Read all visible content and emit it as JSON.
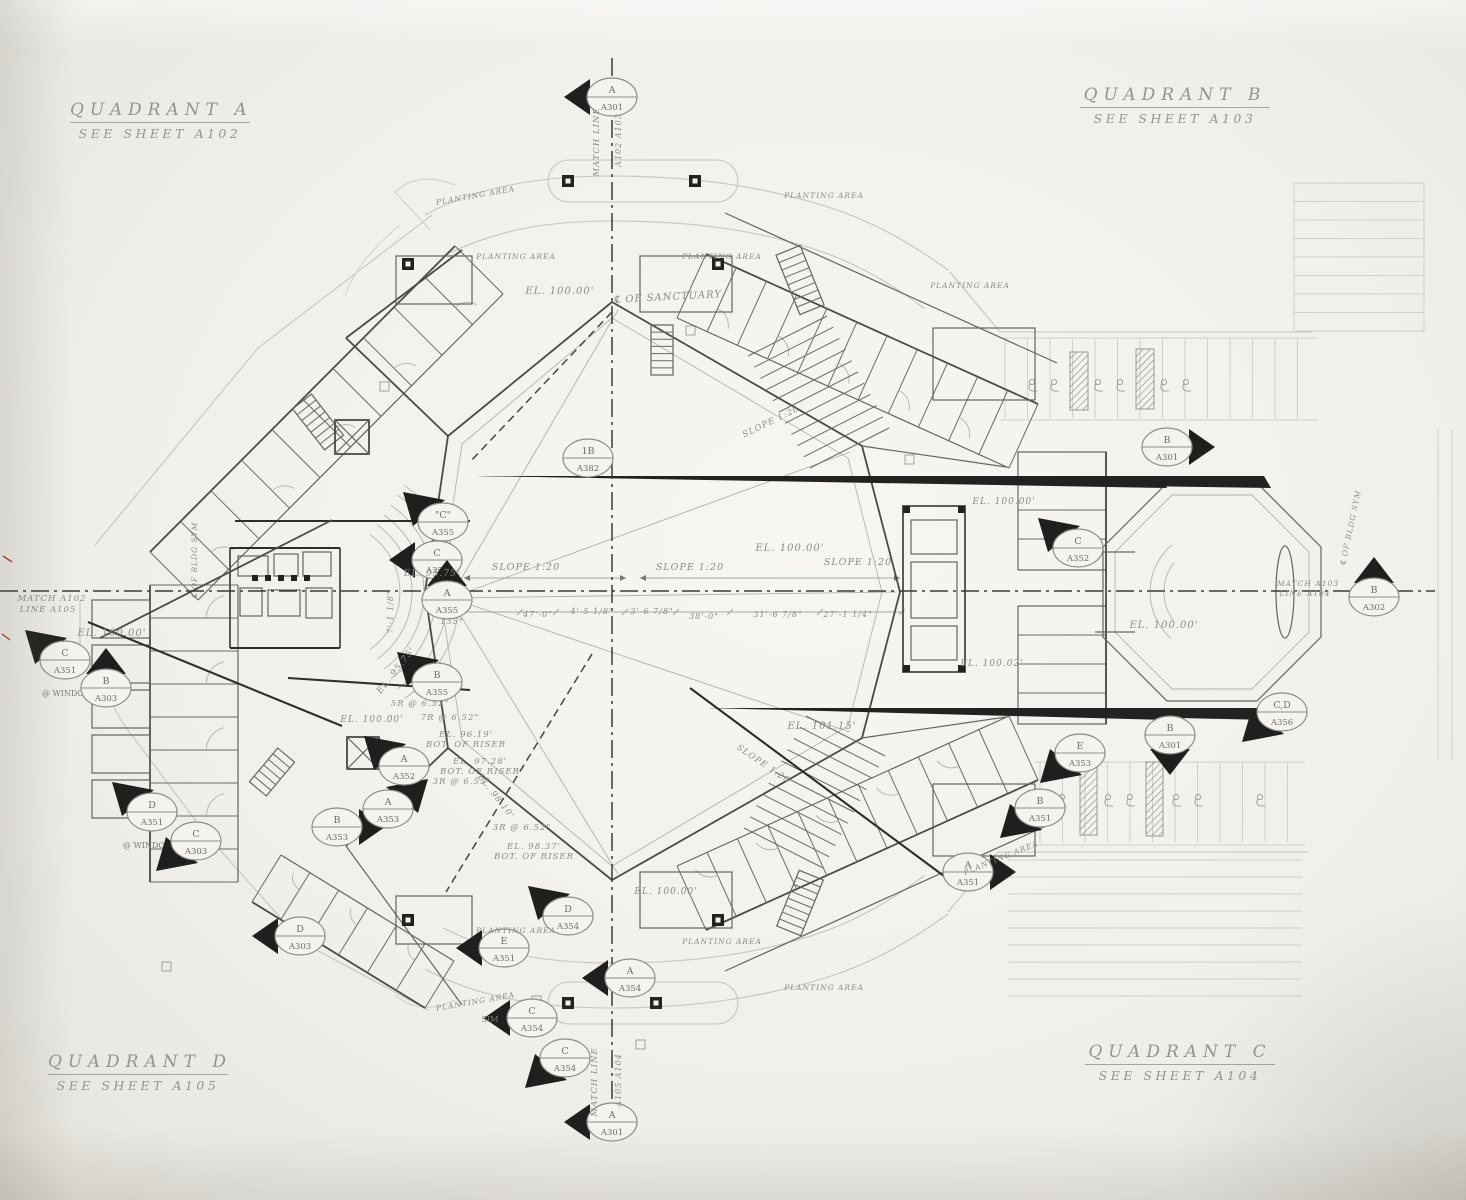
{
  "colors": {
    "paper": "#f2f0ec",
    "ink_dark": "#2e2d2a",
    "ink_mid": "#4c4a46",
    "ink_faded": "#8d8b84",
    "site": "#c7c4bc"
  },
  "quadrants": {
    "a": {
      "name": "QUADRANT A",
      "sheet": "SEE SHEET A102"
    },
    "b": {
      "name": "QUADRANT B",
      "sheet": "SEE SHEET A103"
    },
    "c": {
      "name": "QUADRANT C",
      "sheet": "SEE SHEET A104"
    },
    "d": {
      "name": "QUADRANT D",
      "sheet": "SEE SHEET A105"
    }
  },
  "callouts": [
    {
      "x": 612,
      "y": 97,
      "top": "A",
      "bot": "A301",
      "flag": "l"
    },
    {
      "x": 65,
      "y": 660,
      "top": "C",
      "bot": "A351",
      "flag": "tl",
      "note": "@ WINDOW",
      "nx": 2,
      "ny": 36
    },
    {
      "x": 106,
      "y": 688,
      "top": "B",
      "bot": "A303",
      "flag": "t"
    },
    {
      "x": 152,
      "y": 812,
      "top": "D",
      "bot": "A351",
      "flag": "tl",
      "note": "@ WINDOW",
      "nx": -4,
      "ny": 36
    },
    {
      "x": 196,
      "y": 841,
      "top": "C",
      "bot": "A303",
      "flag": "bl"
    },
    {
      "x": 337,
      "y": 827,
      "top": "B",
      "bot": "A353",
      "flag": "r"
    },
    {
      "x": 388,
      "y": 809,
      "top": "A",
      "bot": "A353",
      "flag": "tr"
    },
    {
      "x": 404,
      "y": 766,
      "top": "A",
      "bot": "A352",
      "flag": "tl"
    },
    {
      "x": 443,
      "y": 522,
      "top": "\"C\"",
      "bot": "A355",
      "flag": "tl"
    },
    {
      "x": 437,
      "y": 560,
      "top": "C",
      "bot": "A355",
      "flag": "l"
    },
    {
      "x": 447,
      "y": 600,
      "top": "A",
      "bot": "A355",
      "flag": "t"
    },
    {
      "x": 437,
      "y": 682,
      "top": "B",
      "bot": "A355",
      "flag": "tl"
    },
    {
      "x": 588,
      "y": 458,
      "top": "1B",
      "bot": "A382",
      "flag": "n"
    },
    {
      "x": 1078,
      "y": 548,
      "top": "C",
      "bot": "A352",
      "flag": "tl"
    },
    {
      "x": 1167,
      "y": 447,
      "top": "B",
      "bot": "A301",
      "flag": "r"
    },
    {
      "x": 1374,
      "y": 597,
      "top": "B",
      "bot": "A302",
      "flag": "t"
    },
    {
      "x": 1282,
      "y": 712,
      "top": "C,D",
      "bot": "A356",
      "flag": "bl"
    },
    {
      "x": 1170,
      "y": 735,
      "top": "B",
      "bot": "A301",
      "flag": "b"
    },
    {
      "x": 1080,
      "y": 753,
      "top": "E",
      "bot": "A353",
      "flag": "bl"
    },
    {
      "x": 1040,
      "y": 808,
      "top": "B",
      "bot": "A351",
      "flag": "bl"
    },
    {
      "x": 968,
      "y": 872,
      "top": "A",
      "bot": "A351",
      "flag": "r"
    },
    {
      "x": 568,
      "y": 916,
      "top": "D",
      "bot": "A354",
      "flag": "tl"
    },
    {
      "x": 630,
      "y": 978,
      "top": "A",
      "bot": "A354",
      "flag": "l"
    },
    {
      "x": 532,
      "y": 1018,
      "top": "C",
      "bot": "A354",
      "flag": "l",
      "note": "SIM",
      "nx": -42,
      "ny": 4
    },
    {
      "x": 565,
      "y": 1058,
      "top": "C",
      "bot": "A354",
      "flag": "bl"
    },
    {
      "x": 300,
      "y": 936,
      "top": "D",
      "bot": "A303",
      "flag": "l"
    },
    {
      "x": 504,
      "y": 948,
      "top": "E",
      "bot": "A351",
      "flag": "l"
    },
    {
      "x": 612,
      "y": 1122,
      "top": "A",
      "bot": "A301",
      "flag": "l"
    }
  ],
  "labels": [
    {
      "t": "EL. 100.00'",
      "x": 560,
      "y": 294
    },
    {
      "t": "℄ OF SANCTUARY",
      "x": 668,
      "y": 300,
      "r": -3
    },
    {
      "t": "EL. 100.00'",
      "x": 112,
      "y": 636
    },
    {
      "t": "EL. 100.00'",
      "x": 790,
      "y": 551
    },
    {
      "t": "EL. 100.00'",
      "x": 1004,
      "y": 504,
      "s": 9
    },
    {
      "t": "EL. 100.02'",
      "x": 992,
      "y": 666,
      "s": 9
    },
    {
      "t": "EL. 100.00'",
      "x": 1164,
      "y": 628
    },
    {
      "t": "EL. 100.00'",
      "x": 666,
      "y": 894,
      "s": 9
    },
    {
      "t": "EL. 100.00'",
      "x": 372,
      "y": 722,
      "s": 9
    },
    {
      "t": "EL. 101.15'",
      "x": 822,
      "y": 729
    },
    {
      "t": "EL. 95.75'",
      "x": 432,
      "y": 576,
      "s": 9
    },
    {
      "t": "EL. 95.75'",
      "x": 398,
      "y": 672,
      "r": -52,
      "s": 9
    },
    {
      "t": "SLOPE 1:20",
      "x": 526,
      "y": 570,
      "s": 9.5
    },
    {
      "t": "SLOPE 1:20",
      "x": 690,
      "y": 570,
      "s": 9.5
    },
    {
      "t": "SLOPE 1:20",
      "x": 858,
      "y": 565,
      "s": 9.5
    },
    {
      "t": "SLOPE 1:20",
      "x": 772,
      "y": 424,
      "r": -26,
      "s": 8.5
    },
    {
      "t": "SLOPE 1:20",
      "x": 762,
      "y": 766,
      "r": 34,
      "s": 8.5
    },
    {
      "t": "PLANTING AREA",
      "x": 476,
      "y": 198,
      "r": -10,
      "s": 7.5
    },
    {
      "t": "PLANTING AREA",
      "x": 516,
      "y": 259,
      "s": 7.5
    },
    {
      "t": "PLANTING AREA",
      "x": 722,
      "y": 259,
      "s": 7.5
    },
    {
      "t": "PLANTING AREA",
      "x": 824,
      "y": 198,
      "s": 7.5
    },
    {
      "t": "PLANTING AREA",
      "x": 970,
      "y": 288,
      "s": 7.5
    },
    {
      "t": "PLANTING AREA",
      "x": 516,
      "y": 933,
      "s": 7.5
    },
    {
      "t": "PLANTING AREA",
      "x": 722,
      "y": 944,
      "s": 7.5
    },
    {
      "t": "PLANTING AREA",
      "x": 824,
      "y": 990,
      "s": 7.5
    },
    {
      "t": "PLANTING AREA",
      "x": 1002,
      "y": 860,
      "r": -22,
      "s": 7.5
    },
    {
      "t": "PLANTING AREA",
      "x": 476,
      "y": 1004,
      "r": -10,
      "s": 7.5
    },
    {
      "t": "5R @ 6.52\"",
      "x": 420,
      "y": 706,
      "s": 8.5
    },
    {
      "t": "7R @ 6.52\"",
      "x": 450,
      "y": 720,
      "s": 8.5
    },
    {
      "t": "EL. 96.19'",
      "x": 466,
      "y": 737,
      "s": 8.5
    },
    {
      "t": "BOT. OF RISER",
      "x": 466,
      "y": 747,
      "s": 8.5
    },
    {
      "t": "EL. 97.28'",
      "x": 480,
      "y": 764,
      "s": 8.5
    },
    {
      "t": "BOT. OF RISER",
      "x": 480,
      "y": 774,
      "s": 8.5
    },
    {
      "t": "3R @ 6.53\"",
      "x": 462,
      "y": 784,
      "s": 8.5
    },
    {
      "t": "EL. 98.10'",
      "x": 494,
      "y": 798,
      "r": 52,
      "s": 8.5
    },
    {
      "t": "3R @ 6.52\"",
      "x": 522,
      "y": 830,
      "s": 8.5
    },
    {
      "t": "EL. 98.37'",
      "x": 534,
      "y": 849,
      "s": 8.5
    },
    {
      "t": "BOT. OF RISER",
      "x": 534,
      "y": 859,
      "s": 8.5
    },
    {
      "t": "47'-0\"",
      "x": 538,
      "y": 617,
      "s": 8
    },
    {
      "t": "4'-5 1/8\"",
      "x": 592,
      "y": 614,
      "s": 8
    },
    {
      "t": "3'-6 7/8\"",
      "x": 652,
      "y": 614,
      "s": 8
    },
    {
      "t": "38'-0\"",
      "x": 704,
      "y": 619,
      "s": 8
    },
    {
      "t": "31'-6 7/8\"",
      "x": 778,
      "y": 617,
      "s": 8
    },
    {
      "t": "27'-1 1/4\"",
      "x": 848,
      "y": 617,
      "s": 8
    },
    {
      "t": "135°",
      "x": 452,
      "y": 624,
      "s": 8
    },
    {
      "t": "7'-1 1/8\"",
      "x": 393,
      "y": 612,
      "r": -90,
      "s": 8
    },
    {
      "t": "MATCH LINE",
      "x": 599,
      "y": 142,
      "r": -90,
      "s": 8.5
    },
    {
      "t": "A102  A103",
      "x": 621,
      "y": 140,
      "r": -90,
      "s": 8
    },
    {
      "t": "MATCH LINE",
      "x": 597,
      "y": 1082,
      "r": -90,
      "s": 8.5
    },
    {
      "t": "A105  A104",
      "x": 621,
      "y": 1080,
      "r": -90,
      "s": 8
    },
    {
      "t": "MATCH  A102",
      "x": 52,
      "y": 601,
      "s": 8.5
    },
    {
      "t": "LINE  A105",
      "x": 48,
      "y": 612,
      "s": 8.5
    },
    {
      "t": "MATCH  A103",
      "x": 1308,
      "y": 586,
      "s": 7.5
    },
    {
      "t": "LINE  A104",
      "x": 1305,
      "y": 596,
      "s": 7.5
    },
    {
      "t": "℄ OF BLDG SYM",
      "x": 197,
      "y": 560,
      "r": -90,
      "s": 7.5
    },
    {
      "t": "℄ OF BLDG SYM",
      "x": 1353,
      "y": 528,
      "r": -78,
      "s": 7.5
    }
  ]
}
